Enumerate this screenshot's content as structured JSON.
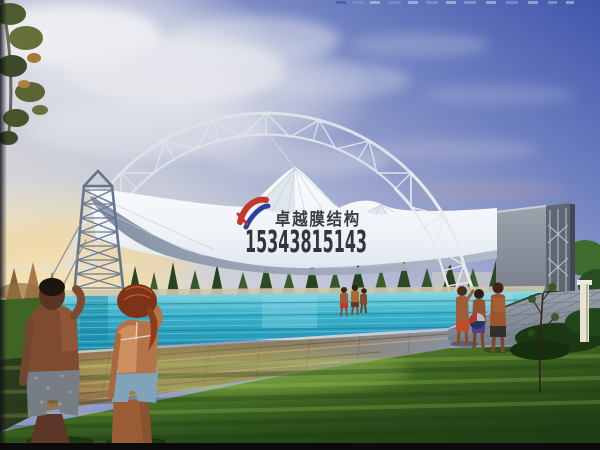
{
  "watermark": {
    "company_name": "卓越膜结构",
    "phone_number": "15343815143",
    "logo_color_red": "#c2382c",
    "logo_color_blue": "#2b3f9e",
    "text_color": "#12151c"
  },
  "scene": {
    "description": "Architectural rendering of a white tensile membrane canopy supported by a steel arch truss and lattice mast over an outdoor swimming pool at sunset, with people on the lawn and pool deck",
    "palette": {
      "sky_deep_blue": "#4156ac",
      "sky_pale": "#d6d8e0",
      "sunset_glow": "#f7e4a9",
      "membrane_white": "#f4f7fa",
      "membrane_shadow": "#8b97ab",
      "steel_truss": "#dde2e8",
      "pool_water": "#2ba4c4",
      "lawn_green": "#5c8f2e",
      "deck_gray": "#8a92a0",
      "deck_wood": "#9a7448"
    }
  }
}
